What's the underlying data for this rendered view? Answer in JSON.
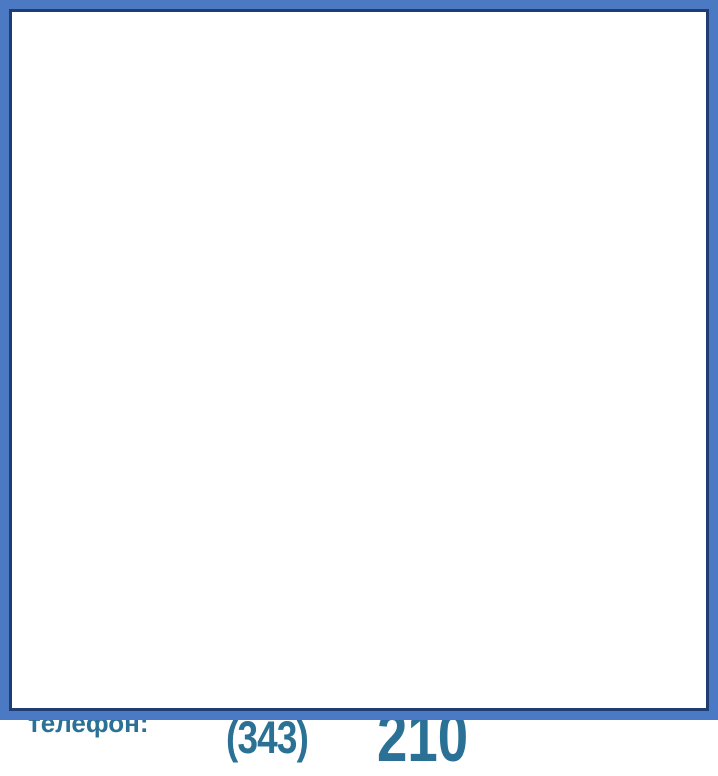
{
  "header": {
    "logo": {
      "icon": "factory-icon",
      "icon_color": "#3b76c0",
      "acronym": "УЗСК",
      "subtitle": "УРАЛЬСКИЙ ЗАВОД СТАЛЬНЫХ КОНСТРУКЦИЙ"
    },
    "title": "Чертеж бака для топлива Б-1,4"
  },
  "drawing": {
    "watermark": {
      "acronym": "УЗСК",
      "subtitle": "УРАЛЬСКИЙ ЗАВОД СТАЛЬНЫХ КОНСТРУКЦИЙ",
      "color": "#bed2ec"
    },
    "front_view": {
      "nozzle_left_label": "Ду 40",
      "nozzle_right_label": "Ду 50",
      "callout_top": "1",
      "callout_corner": "1",
      "callout_support": "2",
      "view_marker": "А",
      "dims": {
        "top": "400*",
        "body": "1400*",
        "total": "2612*",
        "gauge": "300*",
        "cone": "100*",
        "support": "800*",
        "inner": "1100*",
        "width": "1390*",
        "drain_offset": "150*"
      }
    },
    "side_view": {
      "drain_left_label": "Ду 40",
      "drain_right_label": "Ду 15",
      "dims": {
        "left": "250*",
        "right": "500*",
        "feet": "840*",
        "base": "940*"
      }
    },
    "plan_view": {
      "callout_cover": "3",
      "callout_corner": "4",
      "weld_note": "ГОСТ 5264-80-Н1-Δ3",
      "weld_note_flag": "25",
      "dims": {
        "chamfer": "100*",
        "height": "850*",
        "half": "425*",
        "left": "300*",
        "right": "300*",
        "center": "700*",
        "width": "1400*"
      }
    }
  },
  "footer": {
    "email_label": "Наш e-mail:",
    "email_value": "zavod-uzsk@mail.ru",
    "site_label": "Наш сайт:",
    "site_value": "www.zavod-uzsk.ru",
    "phone_label": "Наш телефон:",
    "phone_prefix": "+7 (343)",
    "phone_number": "200-2-210"
  }
}
